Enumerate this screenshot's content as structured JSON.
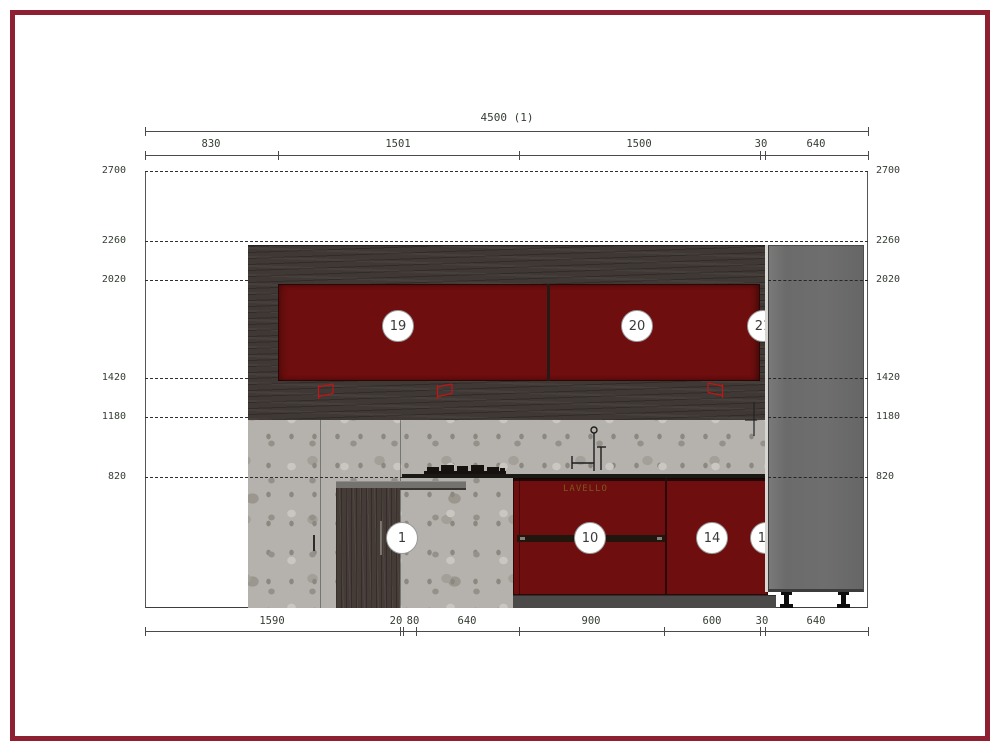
{
  "sheet": {
    "border_color": "#8e2031",
    "background": "#ffffff"
  },
  "drawing_labels": {
    "overall_width": "4500 (1)",
    "top_dimensions": [
      "830",
      "1501",
      "1500",
      "30",
      "640"
    ],
    "bottom_dimensions": [
      "1590",
      "20",
      "80",
      "640",
      "900",
      "600",
      "30",
      "640"
    ],
    "height_levels": [
      "2700",
      "2260",
      "2020",
      "1420",
      "1180",
      "820"
    ],
    "cabinet_circles": [
      "19",
      "20",
      "21",
      "1",
      "10",
      "14",
      "11"
    ],
    "sink_cabinet_text": "LAVELLO"
  },
  "colors": {
    "sheet_border": "#8e2031",
    "door_red": "#6e0e0e",
    "wood_dark": "#3f3835",
    "terrazzo_base": "#b5b2ad",
    "tall_unit_gray": "#6f6e6e",
    "plinth_gray": "#4b4a48",
    "slab_gray": "#74726f",
    "symbol_red": "#c41414",
    "dim_text": "#343d33",
    "dim_line": "#4a4a4a",
    "dash_line": "#2e2e2e"
  }
}
